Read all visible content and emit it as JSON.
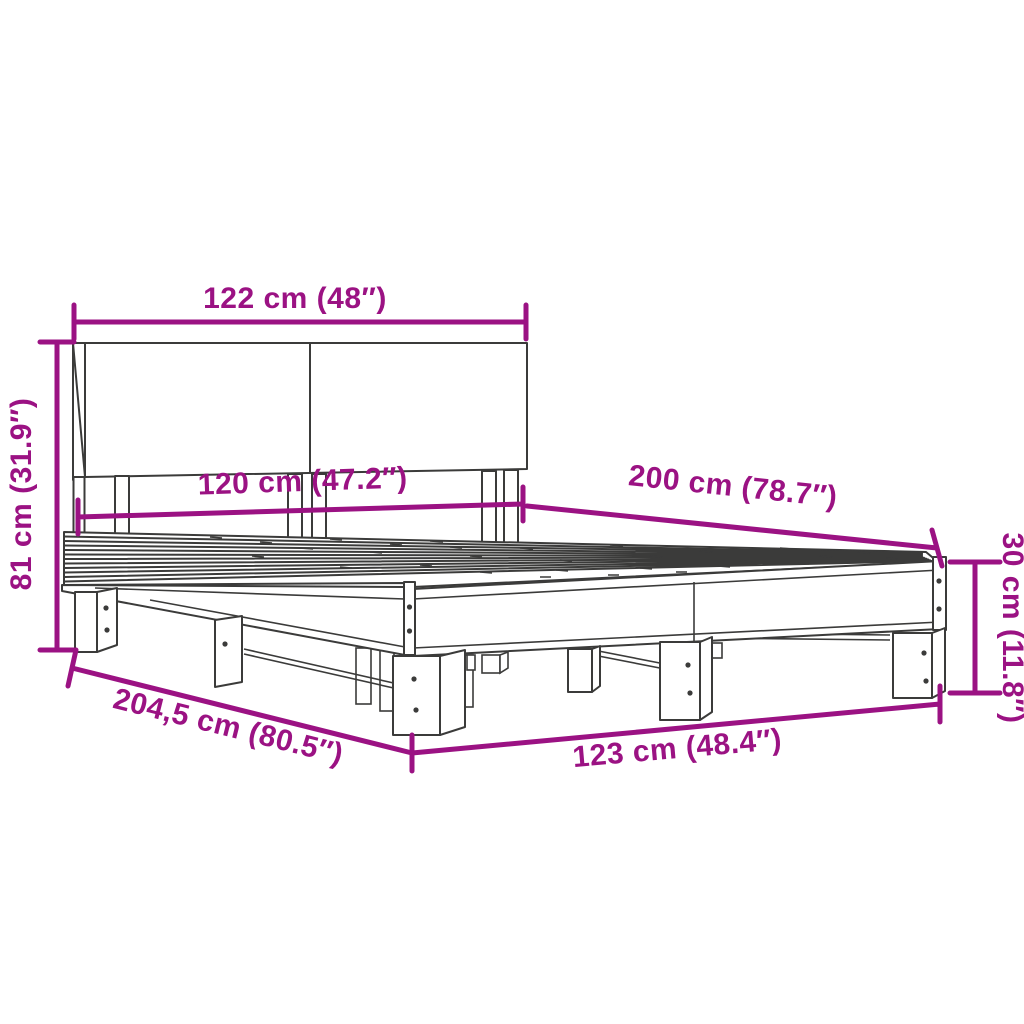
{
  "colors": {
    "dimension_accent": "#9B1283",
    "line_art": "#3B3B3A",
    "background": "#FFFFFF"
  },
  "dimensions": {
    "headboard_width": "122 cm (48″)",
    "headboard_height": "81 cm (31.9″)",
    "inner_width": "120 cm (47.2″)",
    "length": "200 cm (78.7″)",
    "frame_height": "30 cm (11.8″)",
    "total_length": "204,5 cm (80.5″)",
    "outer_width": "123 cm (48.4″)"
  }
}
